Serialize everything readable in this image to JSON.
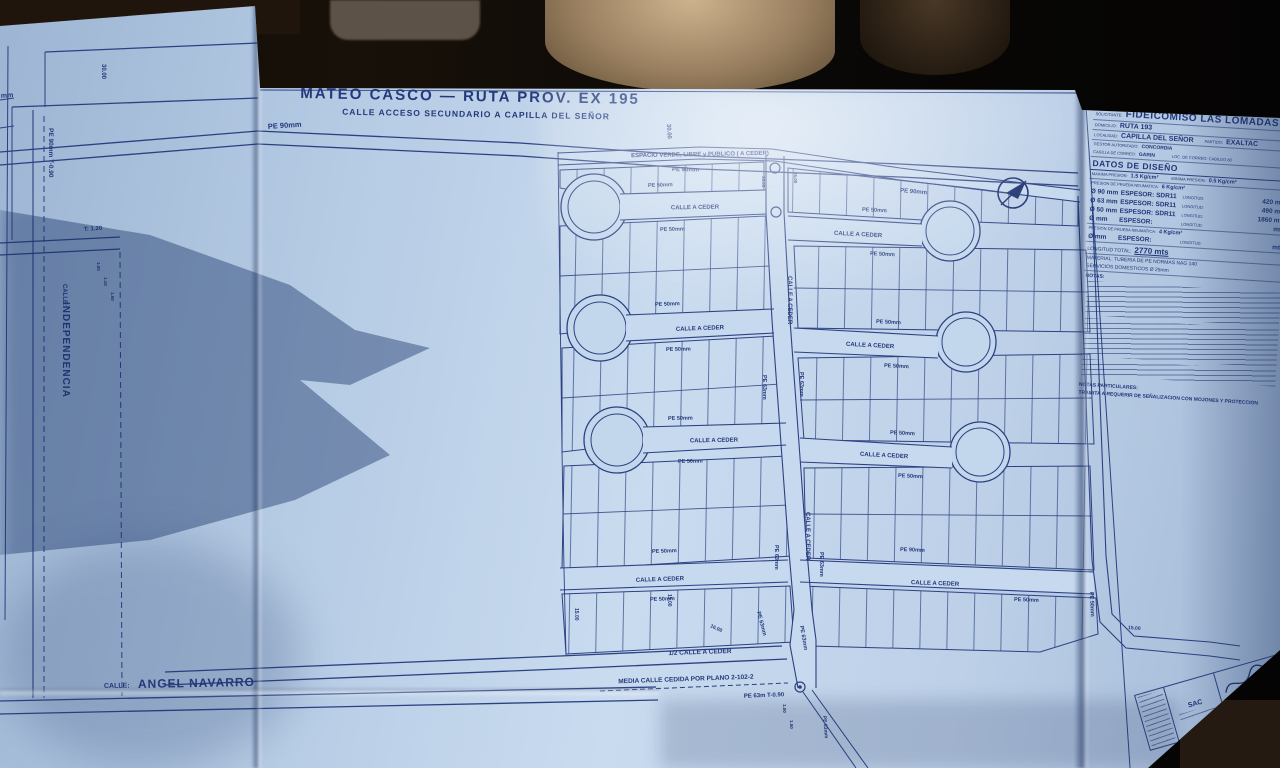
{
  "photo": {
    "setting": "blueprint sheet photographed inside a car"
  },
  "plan": {
    "title": "MATEO CASCO — RUTA PROV. EX 195",
    "subtitle": "CALLE ACCESO SECUNDARIO A CAPILLA DEL SEÑOR",
    "calle_prefix": "CALLE:",
    "independencia": "INDEPENDENCIA",
    "angel_navarro": "ANGEL NAVARRO",
    "espacio_verde": "ESPACIO VERDE, LIBRE y PUBLICO ( A CEDER)",
    "calle_a_ceder": "CALLE A CEDER",
    "half_calle": "1/2 CALLE A CEDER",
    "media_calle": "MEDIA CALLE CEDIDA POR PLANO 2-102-2",
    "pipes": {
      "pe90": "PE 90mm",
      "pe63": "PE 63mm",
      "pe50": "PE 50mm",
      "pe90t": "PE 90mm  T-0.90",
      "pe63t": "PE 63m  T-0.90",
      "mm_cut": "mm"
    },
    "dims": {
      "d30": "30.00",
      "t120": "T: 1.20",
      "d100": "1.00",
      "d110": "1.10",
      "d150": "1.50",
      "d1500": "15.00",
      "d1600": "16.00",
      "d2500": "25.00",
      "d3505": "35.05"
    }
  },
  "title_block": {
    "solicitante_label": "SOLICITANTE:",
    "solicitante": "FIDEICOMISO LAS LOMADAS",
    "domicilio_label": "DOMICILIO:",
    "domicilio": "RUTA 193",
    "localidad_label": "LOCALIDAD:",
    "localidad": "CAPILLA DEL SEÑOR",
    "partido_label": "PARTIDO:",
    "partido": "EXALTAC",
    "gestor_label": "GESTOR AUTORIZADO:",
    "gestor": "CONCORDIA",
    "correo_label": "CASILLA DE CORREO:",
    "correo": "GARIN",
    "loc_correo": "LOC. DE CORREO:  CABILDO 80",
    "datos_header": "DATOS DE DISEÑO",
    "maxima_label": "MAXIMA PRESION:",
    "maxima": "1.5 Kg/cm²",
    "minima_label": "MINIMA PRESION:",
    "minima": "0.5 Kg/cm²",
    "prueba6_label": "PRESION DE PRUEBA NEUMATICA:",
    "prueba6": "6 Kg/cm²",
    "prueba4_label": "PRESION DE PRUEBA NEUMATICA:",
    "prueba4": "4 Kg/cm²",
    "rows": [
      {
        "d": "Ø 90 mm",
        "e": "ESPESOR:  SDR11",
        "l": "LONGITUD:",
        "v": "420 mts"
      },
      {
        "d": "Ø 63 mm",
        "e": "ESPESOR:  SDR11",
        "l": "LONGITUD:",
        "v": "490 mts"
      },
      {
        "d": "Ø 50 mm",
        "e": "ESPESOR:  SDR11",
        "l": "LONGITUD:",
        "v": "1860 mts"
      },
      {
        "d": "Ø    mm",
        "e": "ESPESOR:",
        "l": "LONGITUD:",
        "v": "mts"
      },
      {
        "d": "Ø    mm",
        "e": "ESPESOR:",
        "l": "LONGITUD:",
        "v": "mts"
      }
    ],
    "total_label": "LONGITUD TOTAL:",
    "total": "2770 mts",
    "material": "MATERIAL: TUBERIA DE PE NORMAS NAG 140",
    "servicios": "SERVICIOS DOMESTICOS Ø 25mm",
    "notas_label": "NOTAS:",
    "notas_part_label": "NOTAS PARTICULARES:",
    "tramite": "TRAMITA A REQUERIR DE SEÑALIZACION CON MOJONES Y PROTECCION"
  },
  "sig": {
    "sac": "SAC"
  }
}
